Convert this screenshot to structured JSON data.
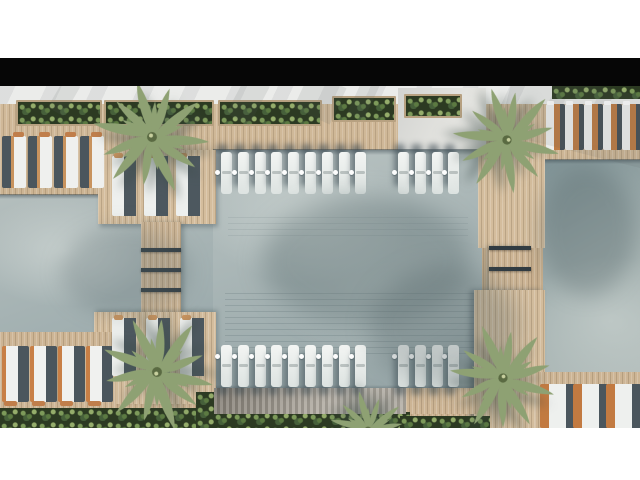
{
  "meta": {
    "description": "Top-down 3D architectural rendering of a resort pool terrace: a large central pool flanked by two side pools, timber decks, bridges with step gaps, rows of sun loungers, in-pool loungers with drink floats, planters and palm trees. No text is visible in the image.",
    "visible_text": []
  },
  "colors": {
    "page_background": "#ffffff",
    "letterbox_bar": "#060606",
    "deck_wood": "#c9b190",
    "deck_wood_light": "#d4bd9d",
    "water": "#a9b6b7",
    "water_light": "#c6cecd",
    "water_dark": "#7f9295",
    "lounger_cushion": "#eff0ee",
    "lounger_shadow": "#4b565d",
    "lounger_wood": "#c07e4b",
    "planter_green": "#2c3a22",
    "palm_green": "#93a577",
    "pergola_gray": "#a39d93",
    "pavement": "#ebecea"
  },
  "scene": {
    "letterbox": {
      "x": 0,
      "y": 58,
      "w": 640,
      "h": 28
    },
    "pools": {
      "center": {
        "x": 213,
        "y": 64,
        "w": 269,
        "h": 240
      },
      "left": {
        "x": 0,
        "y": 109,
        "w": 214,
        "h": 140
      },
      "right": {
        "x": 543,
        "y": 74,
        "w": 97,
        "h": 230
      }
    },
    "planters": [
      {
        "x": 16,
        "y": 14,
        "w": 86,
        "h": 26
      },
      {
        "x": 104,
        "y": 14,
        "w": 110,
        "h": 26
      },
      {
        "x": 218,
        "y": 14,
        "w": 104,
        "h": 26
      },
      {
        "x": 332,
        "y": 10,
        "w": 64,
        "h": 26
      },
      {
        "x": 404,
        "y": 8,
        "w": 58,
        "h": 24
      }
    ],
    "hedges": [
      {
        "x": 552,
        "y": 0,
        "w": 88,
        "h": 13
      },
      {
        "x": 0,
        "y": 322,
        "w": 218,
        "h": 20
      },
      {
        "x": 196,
        "y": 306,
        "w": 22,
        "h": 36
      },
      {
        "x": 214,
        "y": 326,
        "w": 196,
        "h": 16
      },
      {
        "x": 400,
        "y": 330,
        "w": 90,
        "h": 12
      }
    ],
    "bridge_gaps": [
      {
        "x": 141,
        "y": 162,
        "w": 40,
        "h": 4
      },
      {
        "x": 141,
        "y": 182,
        "w": 40,
        "h": 4
      },
      {
        "x": 141,
        "y": 202,
        "w": 40,
        "h": 4
      },
      {
        "x": 489,
        "y": 160,
        "w": 42,
        "h": 4
      },
      {
        "x": 489,
        "y": 181,
        "w": 42,
        "h": 4
      }
    ],
    "lounger_groups": [
      {
        "name": "in-pool-top-left-group",
        "class": "lg-pool top",
        "x": 221,
        "y": 66,
        "w": 11,
        "h": 42,
        "count": 9,
        "step": 16.8
      },
      {
        "name": "in-pool-top-right-group",
        "class": "lg-pool top",
        "x": 398,
        "y": 66,
        "w": 11,
        "h": 42,
        "count": 4,
        "step": 16.8
      },
      {
        "name": "in-pool-bottom-left-group",
        "class": "lg-pool bot",
        "x": 221,
        "y": 259,
        "w": 11,
        "h": 42,
        "count": 9,
        "step": 16.8
      },
      {
        "name": "in-pool-bottom-right-group",
        "class": "lg-pool bot",
        "x": 398,
        "y": 259,
        "w": 11,
        "h": 42,
        "count": 4,
        "step": 16.8
      },
      {
        "name": "deck-loungers-top-left",
        "class": "lg-tl",
        "x": 2,
        "y": 50,
        "w": 24,
        "h": 52,
        "count": 4,
        "step": 26
      },
      {
        "name": "deck-loungers-bottom-left",
        "class": "lg-bl",
        "x": 2,
        "y": 260,
        "w": 27,
        "h": 56,
        "count": 4,
        "step": 28
      },
      {
        "name": "deck-loungers-top-right",
        "class": "lg-tr",
        "x": 546,
        "y": 18,
        "w": 19,
        "h": 46,
        "count": 5,
        "step": 19
      },
      {
        "name": "deck-loungers-bottom-right",
        "class": "lg-br",
        "x": 540,
        "y": 298,
        "w": 35,
        "h": 44,
        "count": 3,
        "step": 33
      },
      {
        "name": "platform-loungers-upper-left",
        "class": "lg-ul",
        "x": 112,
        "y": 70,
        "w": 26,
        "h": 60,
        "count": 3,
        "step": 32
      },
      {
        "name": "platform-loungers-lower-left",
        "class": "lg-ll",
        "x": 112,
        "y": 232,
        "w": 26,
        "h": 58,
        "count": 3,
        "step": 34
      }
    ],
    "palms": [
      {
        "name": "palm-top-left",
        "cx": 152,
        "cy": 51,
        "r": 62,
        "rot": 10
      },
      {
        "name": "palm-top-right",
        "cx": 507,
        "cy": 54,
        "r": 58,
        "rot": 130
      },
      {
        "name": "palm-bottom-left",
        "cx": 157,
        "cy": 286,
        "r": 62,
        "rot": 250
      },
      {
        "name": "palm-bottom-right",
        "cx": 503,
        "cy": 292,
        "r": 58,
        "rot": 65
      },
      {
        "name": "palm-bottom-center",
        "cx": 368,
        "cy": 344,
        "r": 42,
        "rot": 200
      }
    ],
    "soft_shadows": [
      {
        "x": 262,
        "y": 110,
        "w": 210,
        "h": 130,
        "color": "rgba(88,104,108,0.38)",
        "blur": 12,
        "rot": 0
      },
      {
        "x": 60,
        "y": 140,
        "w": 130,
        "h": 90,
        "color": "rgba(88,104,108,0.25)",
        "blur": 10,
        "rot": 0
      },
      {
        "x": 540,
        "y": 80,
        "w": 95,
        "h": 130,
        "color": "rgba(80,96,100,0.30)",
        "blur": 10,
        "rot": 0
      },
      {
        "x": 370,
        "y": 180,
        "w": 150,
        "h": 120,
        "color": "rgba(80,96,100,0.30)",
        "blur": 12,
        "rot": 0
      }
    ],
    "pavement_streaks": [
      {
        "x": 235,
        "y": -8,
        "w": 26,
        "h": 44,
        "rot": 28
      },
      {
        "x": 300,
        "y": -8,
        "w": 40,
        "h": 40,
        "rot": 25
      },
      {
        "x": 355,
        "y": -8,
        "w": 18,
        "h": 40,
        "rot": 25
      },
      {
        "x": 505,
        "y": -4,
        "w": 150,
        "h": 70,
        "rot": 14
      },
      {
        "x": 55,
        "y": -6,
        "w": 18,
        "h": 34,
        "rot": 30
      }
    ]
  }
}
